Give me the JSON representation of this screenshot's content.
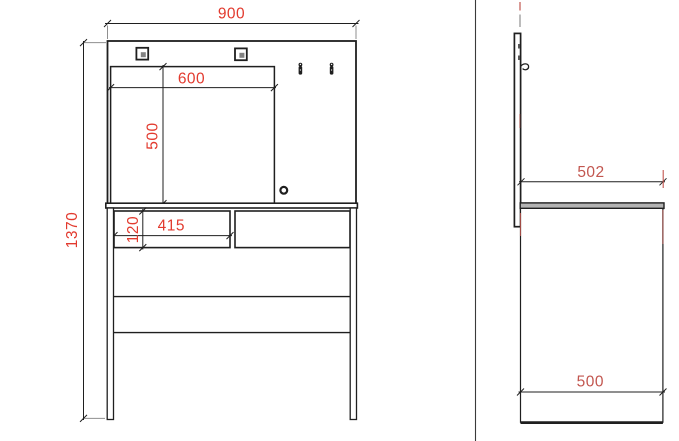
{
  "front_view": {
    "dim_overall_width": "900",
    "dim_mirror_width": "600",
    "dim_mirror_height": "500",
    "dim_overall_height": "1370",
    "dim_drawer_width": "415",
    "dim_drawer_height": "120"
  },
  "side_view": {
    "dim_top_depth": "502",
    "dim_base_depth": "500"
  },
  "colors": {
    "dim_red": "#e23a2e",
    "side_dim_red": "#c2564f",
    "line_dark": "#1f1f1f",
    "ext_gray": "#8f8f8f",
    "panel_gray": "#b3b3b3",
    "inner_square_gray": "#828282"
  }
}
